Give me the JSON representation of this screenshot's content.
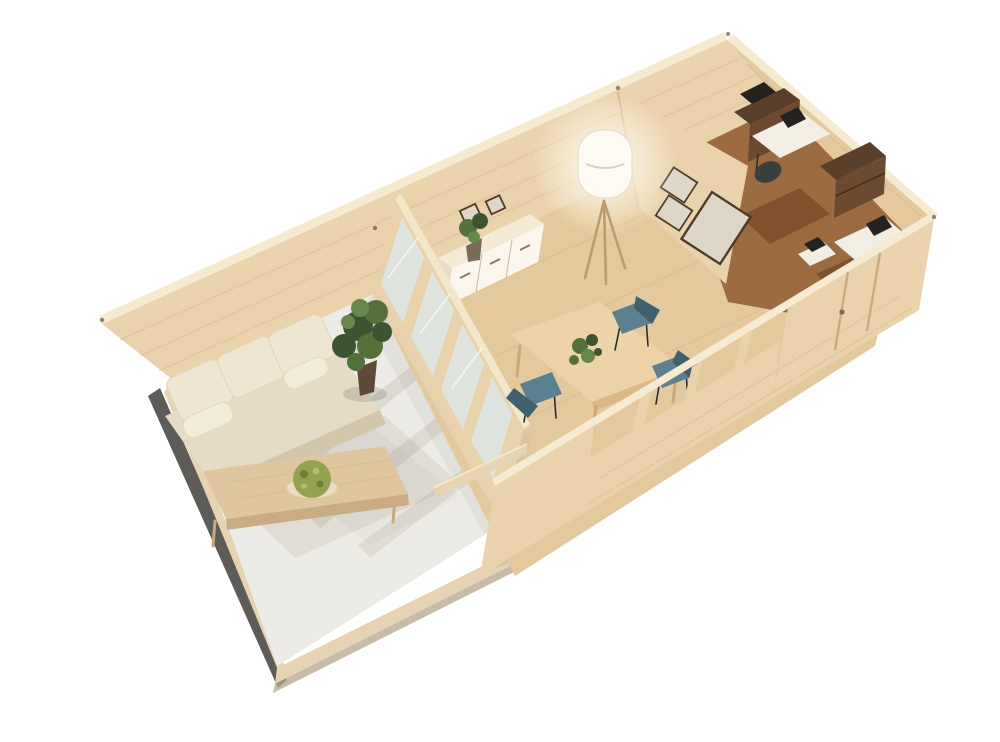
{
  "render": {
    "type": "3d-product-render",
    "subject": "wooden log cabin with terrace, cutaway isometric aerial view",
    "background": "white, no visible text or UI"
  },
  "palette": {
    "bg": "#ffffff",
    "wallInner": "#ead3ac",
    "wallInnerLight": "#f2e2c2",
    "wallTop": "#f6ead0",
    "neWall": "#e4c99f",
    "plankLine": "#cfb186",
    "floorWood": "#e5c99e",
    "floorWoodStreak": "#d7b587",
    "terrace": "#edebe5",
    "terraceStreak": "#ded6c8",
    "deckWood": "#e5d3b2",
    "deckShadow": "#b5a68c",
    "darkEdge": "#3a3833",
    "shadowSoft": "#6b6154",
    "officeFloor": "#9c6b42",
    "officeDark": "#6b4a30",
    "officeShelf": "#5a3f2a",
    "officeMat": "#7a4c2c",
    "deskWhite": "#f3eee4",
    "equip": "#26221f",
    "chairOffice": "#3a3f3c",
    "pictureFrame": "#4f3b28",
    "pictureMat": "#ded6c6",
    "sideboardTop": "#f4ead6",
    "sideboardFront": "#fbf7ee",
    "sideboardSide": "#e8dcc4",
    "lampShade": "#fdfbf4",
    "lampLeg": "#bd9b6e",
    "tableWood": "#ecd3aa",
    "tableEdge": "#d8b989",
    "tableLeg": "#caa87e",
    "chairTeal": "#5d8090",
    "chairTealDark": "#3f616e",
    "chairLeg": "#2c2c2c",
    "plantDark": "#3c5430",
    "plantMid": "#54713c",
    "plantLight": "#68874a",
    "pot": "#5d4a38",
    "moss": "#93a24f",
    "mossDark": "#6f7f39",
    "mossLight": "#b4bf6e",
    "sofaBase": "#e6dcc6",
    "sofaSkirt": "#d3c6aa",
    "sofaCushion": "#efe6d2",
    "sofaBolster": "#f3ecd9",
    "glass": "#dfe5e3",
    "frameWood": "#e7d2ab",
    "frameWoodLight": "#f4e6c8",
    "post": "#dcc49c",
    "coffeeTop": "#dfc69f",
    "coffeeFront": "#c9ac83"
  },
  "scene": {
    "areas": [
      {
        "name": "terrace",
        "items": [
          "three-seat beige sofa",
          "wooden coffee table",
          "round moss bowl centerpiece",
          "potted green plant",
          "light stone floor",
          "folding glass door shadows"
        ]
      },
      {
        "name": "living-dining-room",
        "items": [
          "folding glass door partition",
          "wooden dining table",
          "plant centerpiece",
          "teal dining chairs",
          "white sideboard with plant",
          "framed wall pictures",
          "white floor lamp with tripod legs",
          "wood plank floor"
        ]
      },
      {
        "name": "home-office",
        "items": [
          "two desks with white tops",
          "dark office chairs",
          "brown shelving units",
          "computer equipment",
          "brown floor",
          "side door with vertical trim"
        ]
      }
    ]
  }
}
